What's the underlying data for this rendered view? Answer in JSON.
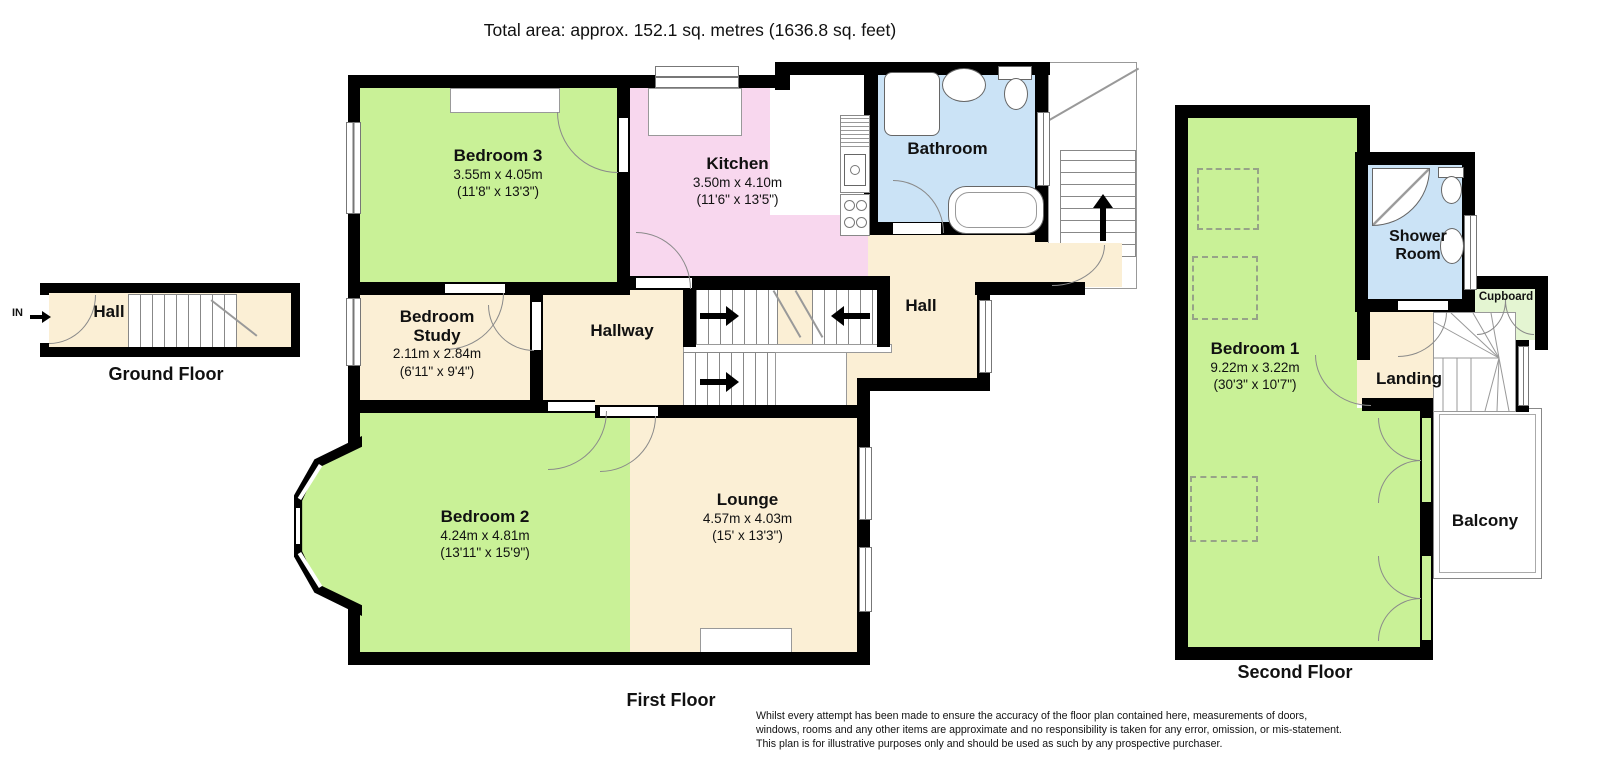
{
  "title": "Total area: approx. 152.1 sq. metres (1636.8 sq. feet)",
  "entrance_label": "IN",
  "floors": {
    "ground": {
      "label": "Ground Floor",
      "hall": {
        "name": "Hall"
      }
    },
    "first": {
      "label": "First Floor",
      "bedroom3": {
        "name": "Bedroom 3",
        "metric": "3.55m x 4.05m",
        "imperial": "(11'8\" x 13'3\")"
      },
      "kitchen": {
        "name": "Kitchen",
        "metric": "3.50m x 4.10m",
        "imperial": "(11'6\" x 13'5\")"
      },
      "bathroom": {
        "name": "Bathroom"
      },
      "study": {
        "name": "Bedroom Study",
        "metric": "2.11m x 2.84m",
        "imperial": "(6'11\" x 9'4\")"
      },
      "hallway": {
        "name": "Hallway"
      },
      "hall": {
        "name": "Hall"
      },
      "bedroom2": {
        "name": "Bedroom 2",
        "metric": "4.24m x 4.81m",
        "imperial": "(13'11\" x 15'9\")"
      },
      "lounge": {
        "name": "Lounge",
        "metric": "4.57m x 4.03m",
        "imperial": "(15' x 13'3\")"
      }
    },
    "second": {
      "label": "Second Floor",
      "bedroom1": {
        "name": "Bedroom 1",
        "metric": "9.22m x 3.22m",
        "imperial": "(30'3\" x 10'7\")"
      },
      "shower": {
        "name": "Shower Room"
      },
      "cupboard": {
        "name": "Cupboard"
      },
      "landing": {
        "name": "Landing"
      },
      "balcony": {
        "name": "Balcony"
      }
    }
  },
  "disclaimer": {
    "line1": "Whilst every attempt has been made to ensure the accuracy of the floor plan contained here, measurements of doors,",
    "line2": "windows, rooms and any other items are approximate and no responsibility is taken for any error, omission, or mis-statement.",
    "line3": "This plan is for illustrative purposes only and should be used as such by any prospective purchaser."
  },
  "colors": {
    "room_green": "#c9f197",
    "room_pink": "#f8d7ee",
    "room_blue": "#cbe3f6",
    "floor_cream": "#fbefd5",
    "cupboard_green": "#e4f5d2",
    "wall": "#000000"
  }
}
